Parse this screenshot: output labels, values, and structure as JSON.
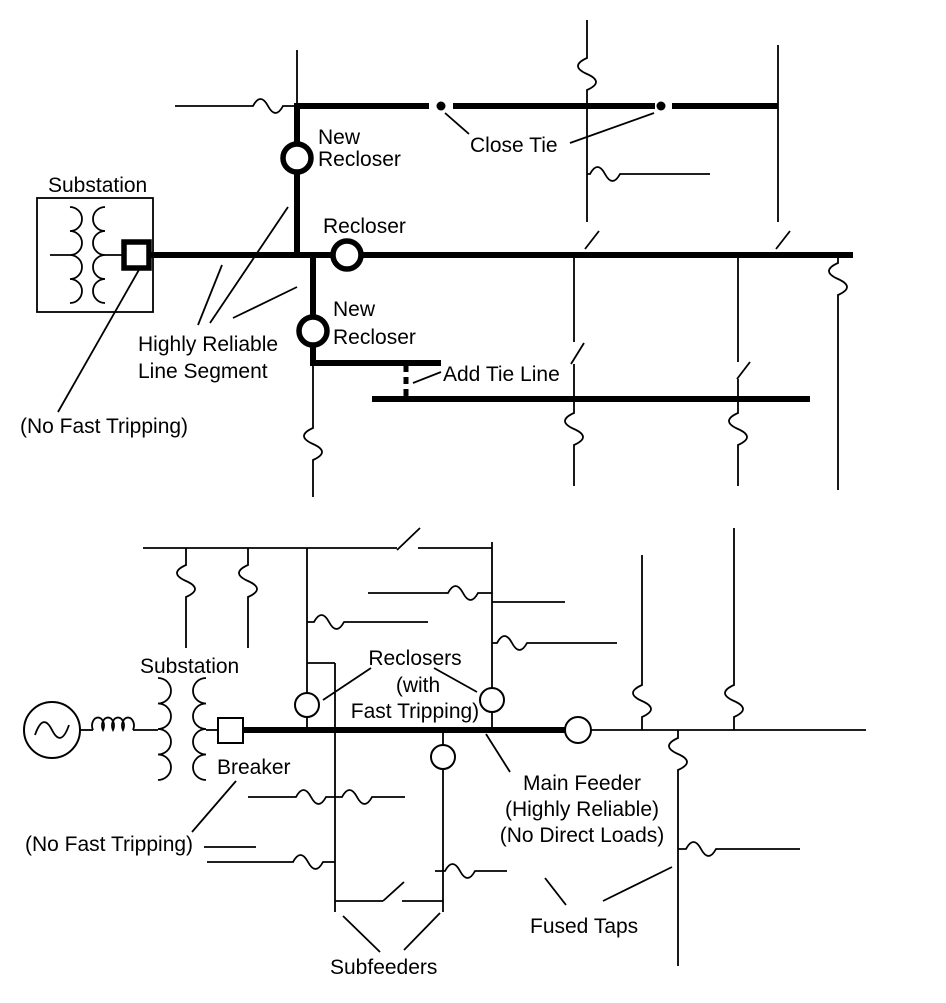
{
  "figure": {
    "background_color": "#ffffff",
    "line_color": "#000000"
  },
  "top_diagram": {
    "substation_label": "Substation",
    "new_recloser_upper_label_line1": "New",
    "new_recloser_upper_label_line2": "Recloser",
    "recloser_label": "Recloser",
    "close_tie_label": "Close Tie",
    "new_recloser_lower_label_line1": "New",
    "new_recloser_lower_label_line2": "Recloser",
    "highly_reliable_label_line1": "Highly Reliable",
    "highly_reliable_label_line2": "Line Segment",
    "add_tie_line_label": "Add Tie Line",
    "no_fast_tripping_label": "(No Fast Tripping)"
  },
  "bottom_diagram": {
    "substation_label": "Substation",
    "breaker_label": "Breaker",
    "reclosers_label_line1": "Reclosers",
    "reclosers_label_line2": "(with",
    "reclosers_label_line3": "Fast Tripping)",
    "main_feeder_label_line1": "Main Feeder",
    "main_feeder_label_line2": "(Highly Reliable)",
    "main_feeder_label_line3": "(No Direct Loads)",
    "no_fast_tripping_label": "(No Fast Tripping)",
    "fused_taps_label": "Fused Taps",
    "subfeeders_label": "Subfeeders"
  }
}
